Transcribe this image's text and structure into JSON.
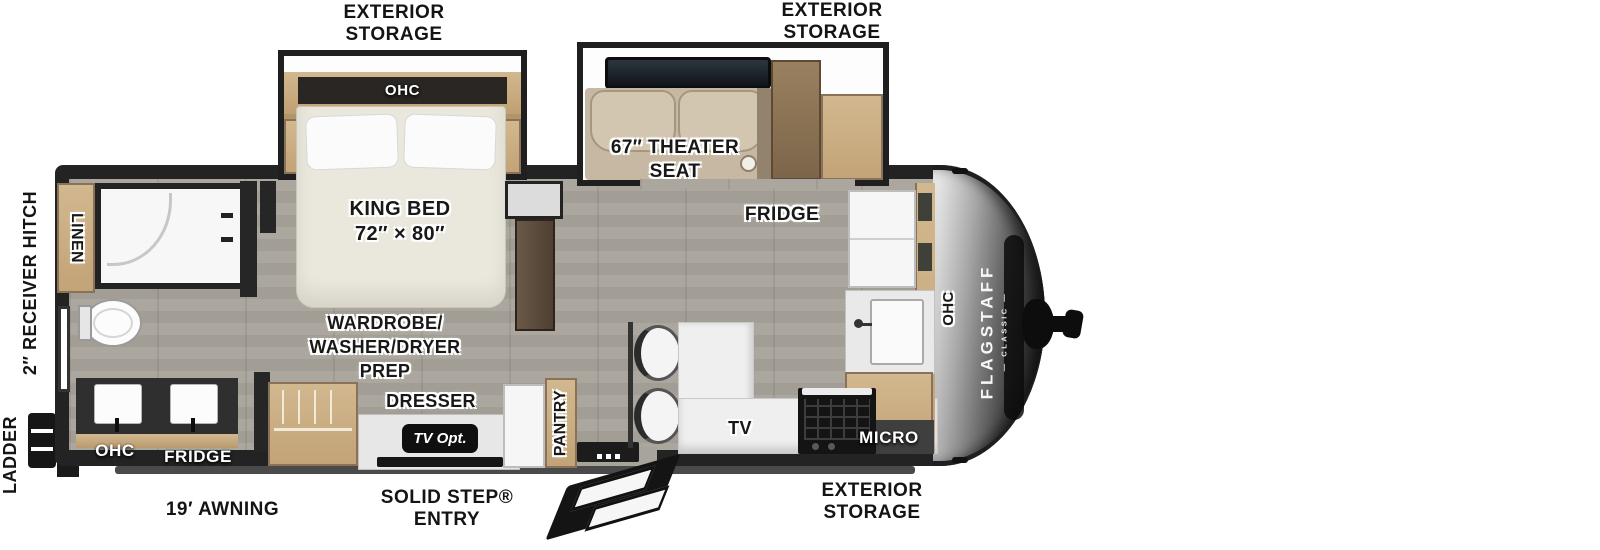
{
  "brand": {
    "name": "FLAGSTAFF",
    "series": "CLASSIC"
  },
  "exterior": {
    "storage_top_left": [
      "EXTERIOR",
      "STORAGE"
    ],
    "storage_top_right": [
      "EXTERIOR",
      "STORAGE"
    ],
    "storage_bottom": [
      "EXTERIOR",
      "STORAGE"
    ],
    "awning": "19′ AWNING",
    "entry": [
      "SOLID STEP®",
      "ENTRY"
    ],
    "ladder": "LADDER",
    "hitch": "2″ RECEIVER HITCH"
  },
  "bedroom": {
    "ohc": "OHC",
    "bed": [
      "KING BED",
      "72″ × 80″"
    ],
    "wardrobe": [
      "WARDROBE/",
      "WASHER/DRYER",
      "PREP"
    ],
    "dresser": "DRESSER",
    "tv_opt": "TV Opt."
  },
  "living": {
    "theater": [
      "67″ THEATER",
      "SEAT"
    ],
    "fridge": "FRIDGE",
    "pantry": "PANTRY",
    "tv": "TV"
  },
  "kitchen": {
    "micro": "MICRO",
    "ohc": "OHC"
  },
  "bath": {
    "linen": "LINEN",
    "ohc": "OHC",
    "fridge": "FRIDGE"
  },
  "palette": {
    "wall": "#262626",
    "floor": "#a8a39b",
    "wood": "#c9ae85",
    "seat": "#c6b8a2",
    "cap_dark": "#181818",
    "label": "#181818"
  }
}
